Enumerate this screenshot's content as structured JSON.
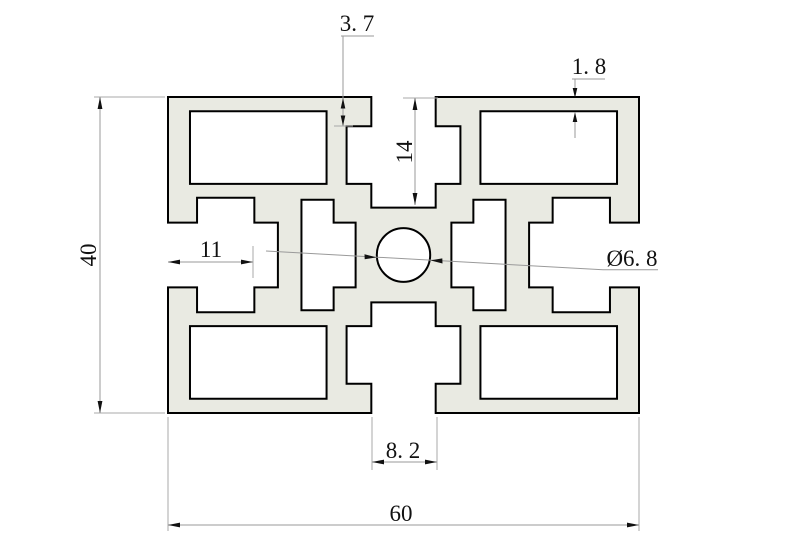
{
  "drawing": {
    "kind": "aluminum-extrusion-profile-cross-section",
    "colors": {
      "background": "#ffffff",
      "profile_fill": "#e9eae2",
      "outline": "#000000",
      "dimension_lines": "#9a9a9a",
      "text": "#111111"
    },
    "dims": {
      "overall_width": "60",
      "overall_height": "40",
      "slot_depth_top": "14",
      "slot_depth_side": "11",
      "slot_lip_depth": "3. 7",
      "top_wall_thickness": "1. 8",
      "slot_opening_width": "8. 2",
      "center_hole_diameter": "Ø6. 8"
    }
  }
}
